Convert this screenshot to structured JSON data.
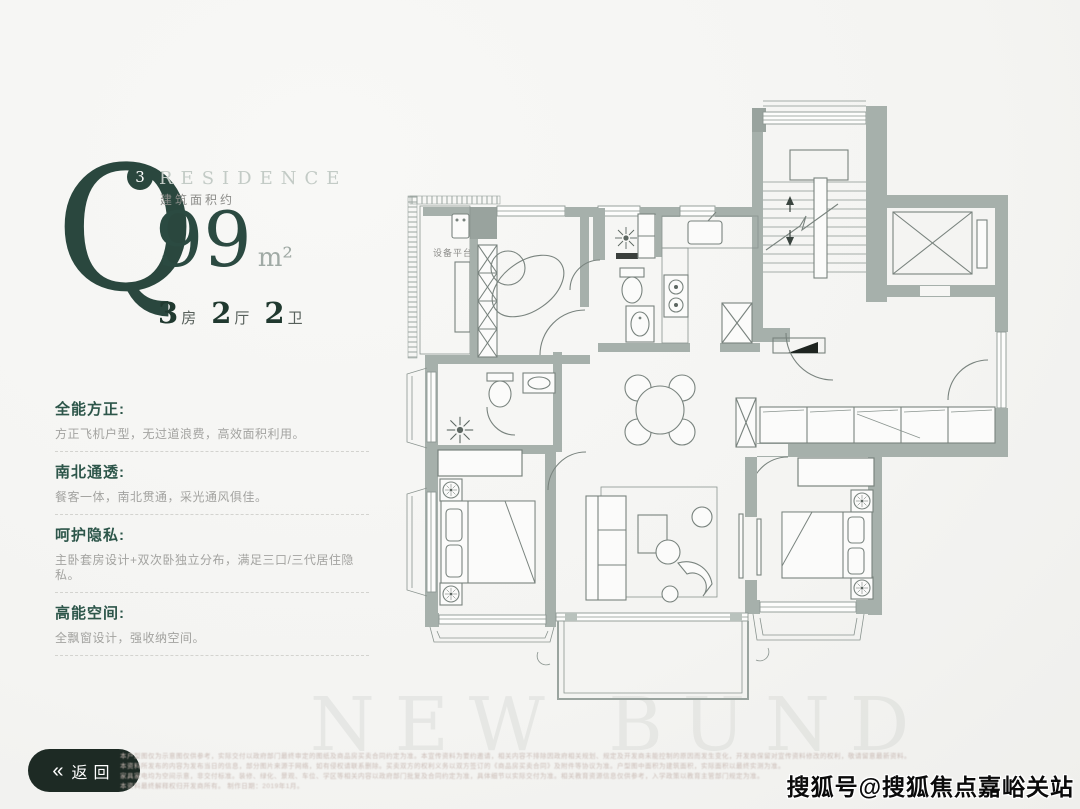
{
  "header": {
    "letter": "Q",
    "superscript": "3",
    "brand": "RESIDENCE",
    "area_label": "建筑面积约",
    "area_value": "99",
    "area_unit": "m²",
    "layout": [
      {
        "num": "3",
        "unit": "房"
      },
      {
        "num": "2",
        "unit": "厅"
      },
      {
        "num": "2",
        "unit": "卫"
      }
    ]
  },
  "features": [
    {
      "title": "全能方正:",
      "desc": "方正飞机户型，无过道浪费，高效面积利用。"
    },
    {
      "title": "南北通透:",
      "desc": "餐客一体，南北贯通，采光通风俱佳。"
    },
    {
      "title": "呵护隐私:",
      "desc": "主卧套房设计+双次卧独立分布，满足三口/三代居住隐私。"
    },
    {
      "title": "高能空间:",
      "desc": "全飘窗设计，强收纳空间。"
    }
  ],
  "floorplan": {
    "platform_label": "设备平台"
  },
  "footer": {
    "back_icon": "«",
    "back_label": "返回",
    "watermark": "搜狐号@搜狐焦点嘉峪关站",
    "background_watermark": "NEW BUND",
    "disclaimer_lines": [
      "本户型图仅为示意图仅供参考，实际交付以政府部门最终审定的图纸及商品房买卖合同约定为准。本宣传资料为要约邀请，相关内容不排除因政府相关规划、规定及开发商未能控制的原因而发生变化，开发商保留对宣传资料修改的权利，敬请留意最新资料。",
      "本资料所发布的内容为发布当日的信息，部分图片来源于网络，如有侵权请联系删除。买卖双方的权利义务以双方签订的《商品房买卖合同》及附件等协议为准。户型图中面积为建筑面积，实际面积以最终实测为准。",
      "家具家电均为空间示意，非交付标准。装修、绿化、景观、车位、学区等相关内容以政府部门批复及合同约定为准，具体细节以实际交付为准。相关教育资源信息仅供参考，入学政策以教育主管部门规定为准。",
      "本资料最终解释权归开发商所有。 制作日期：2019年1月。"
    ]
  },
  "colors": {
    "accent_green": "#2a473e",
    "wall_gray": "#a6b0ab",
    "line_gray": "#79837e",
    "text_gray": "#a3a3a0",
    "back_button_bg": "#1d2a24"
  }
}
